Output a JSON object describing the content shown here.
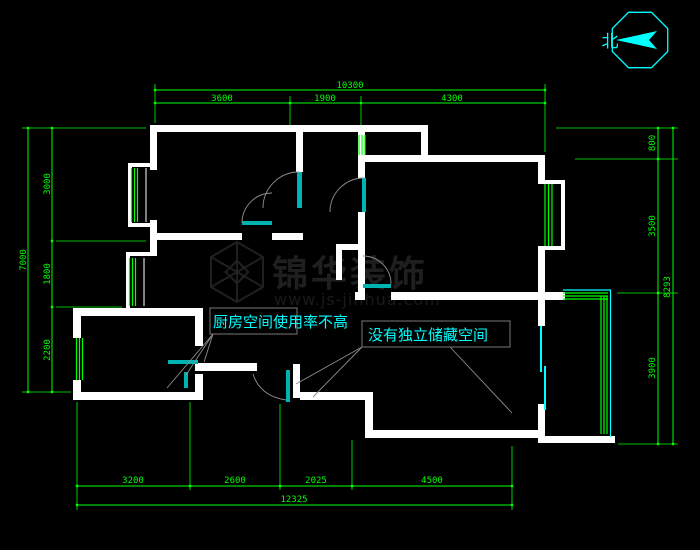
{
  "compass": {
    "north_label": "北"
  },
  "watermark": {
    "title": "锦华装饰",
    "url": "www.js-jinhua.com"
  },
  "annotations": {
    "kitchen": {
      "text": "厨房空间使用率不高"
    },
    "storage": {
      "text": "没有独立储藏空间"
    }
  },
  "dimensions": {
    "top": {
      "total": "10300",
      "segments": [
        "3600",
        "1900",
        "4300"
      ]
    },
    "bottom": {
      "total": "12325",
      "segments": [
        "3200",
        "2600",
        "2025",
        "4500"
      ]
    },
    "left": {
      "total": "7000",
      "segments": [
        "3000",
        "1800",
        "2200"
      ]
    },
    "right": {
      "total": "8293",
      "segments": [
        "800",
        "3500",
        "3900"
      ]
    }
  },
  "colors": {
    "background": "#000000",
    "wall": "#ffffff",
    "window": "#00ff00",
    "door": "#00b3b3",
    "dimension": "#00ff00",
    "annotation": "#00ffff",
    "compass": "#00ffff",
    "leader": "#909090",
    "watermark": "#1f1f1f"
  }
}
